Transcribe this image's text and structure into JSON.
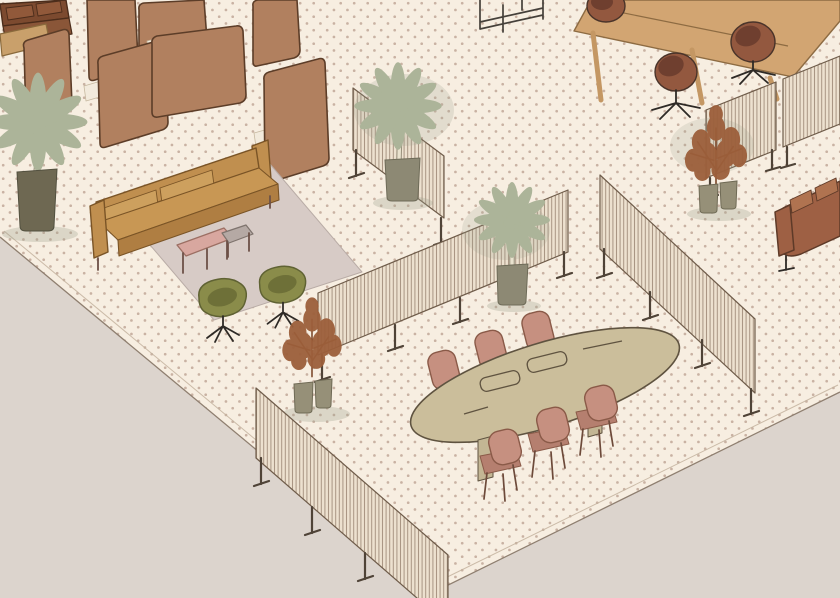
{
  "scene": {
    "description": "Hand-drawn isometric illustration of an open-plan office zone on a dotted cream carpet over a grey floor; no text or UI controls are visible.",
    "elements": [
      {
        "id": "booth-cluster",
        "label": "acoustic privacy booths with built-in tables and seats"
      },
      {
        "id": "corner-sofa",
        "label": "dark brown sofa with coffee table (top-left corner, cropped)"
      },
      {
        "id": "shelf-rack",
        "label": "black metal shelving rack (top, cropped)"
      },
      {
        "id": "lounge-area",
        "label": "tan sofa on grey rug with pink and grey coffee tables and two olive swivel lounge chairs"
      },
      {
        "id": "meeting-area",
        "label": "oval beige meeting table with six dusty-pink chairs"
      },
      {
        "id": "work-table",
        "label": "long wooden table with three rust swivel chairs (top-right, cropped)"
      },
      {
        "id": "leather-sofa",
        "label": "rust-brown leather sofa (right edge, cropped)"
      },
      {
        "id": "privacy-screens",
        "label": "six slatted freestanding divider screens on thin legs"
      },
      {
        "id": "plants",
        "label": "three potted sage palms and two rust-coloured potted shrubs"
      }
    ]
  },
  "colors": {
    "floor_outside": "#DCD4CD",
    "carpet": "#F7EEE1",
    "carpet_dot": "#C9B2A3",
    "carpet_edge": "#8F7F70",
    "screen_base": "#EDE1CF",
    "screen_stripe": "#8F7865",
    "screen_edge": "#6F5C4A",
    "screen_leg": "#4F4337",
    "booth_panel": "#B1805F",
    "booth_outline": "#5C3D28",
    "booth_table": "#74503A",
    "booth_seat": "#F2EADC",
    "sofa_tan": "#C08F4F",
    "sofa_tan_cushion": "#CDA05E",
    "sofa_tan_dark": "#AF7E42",
    "sofa_outline": "#7A5426",
    "sofa_dark_brown": "#7C4A2F",
    "sofa_dark_cushion": "#91593A",
    "sofa_rust": "#9E6044",
    "sofa_rust_light": "#B07350",
    "sofa_rust_outline": "#5E3A28",
    "rug": "#D7CBC6",
    "rug_edge": "#B9ACA6",
    "mat_white": "#F6F0E1",
    "table_pink": "#D8A79F",
    "table_pink_edge": "#9C6F63",
    "table_gray": "#B5A9A4",
    "table_gray_edge": "#7E736D",
    "chair_olive": "#8A8C4A",
    "chair_olive_dark": "#6E7038",
    "chair_olive_edge": "#5F6233",
    "conf_table": "#CBBE9B",
    "conf_table_edge": "#5F5340",
    "conf_leg": "#C3B694",
    "chair_pink": "#C69080",
    "chair_pink_dark": "#B57F6F",
    "chair_pink_edge": "#8A5A48",
    "wood_table": "#D2A572",
    "wood_table_edge": "#8D6B42",
    "chair_rust": "#93583F",
    "chair_rust_dark": "#6F3F2F",
    "chair_rust_edge": "#4A342A",
    "palm_green": "#ACB499",
    "trunk": "#E9E2CE",
    "trunk_edge": "#9A927E",
    "plant_rust": "#9C5F3B",
    "plant_rust_dark": "#7A4527",
    "pot_dark": "#6E6852",
    "pot_gray": "#8D8974",
    "pot_sage": "#969078",
    "shadow": "#9AA08C",
    "metal": "#45403A"
  }
}
